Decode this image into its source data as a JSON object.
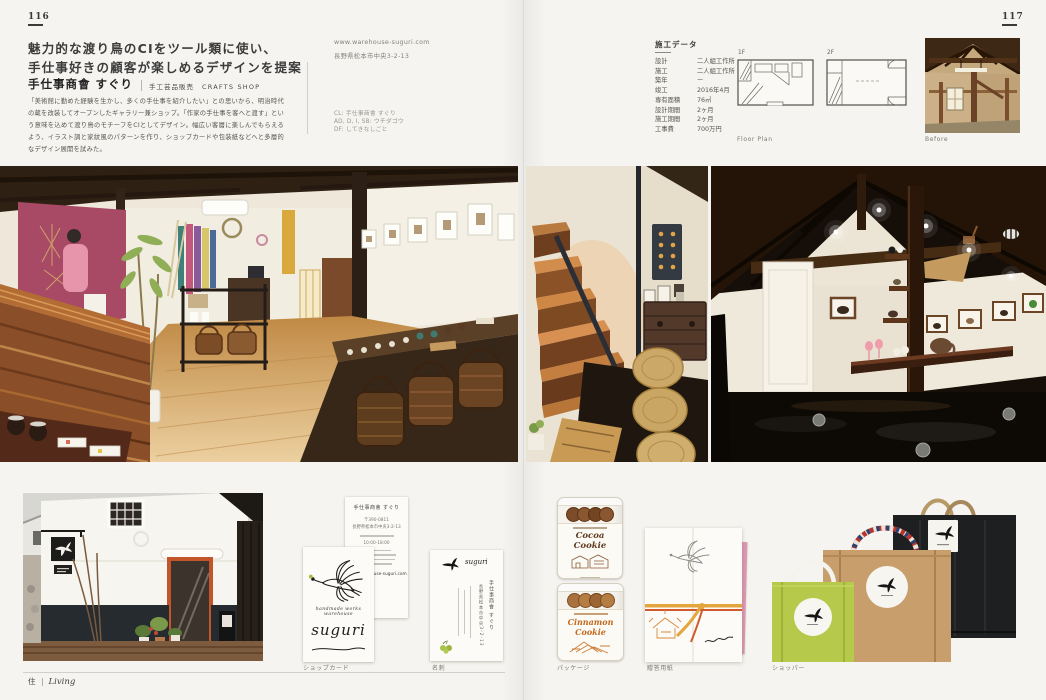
{
  "page": {
    "left_number": "116",
    "right_number": "117"
  },
  "header": {
    "headline1": "魅力的な渡り鳥のCIをツール類に使い、",
    "headline2": "手仕事好きの顧客が楽しめるデザインを提案",
    "shop_name": "手仕事商會 すぐり",
    "category_jp": "手工芸品販売",
    "category_en": "CRAFTS SHOP",
    "body": "「美術館に勤めた経験を生かし、多くの手仕事を紹介したい」との思いから、明治時代の蔵を改装してオープンしたギャラリー兼ショップ。「作家の手仕事を客へと渡す」という意味を込めて渡り鳥のモチーフをCIとしてデザイン。幅広い客層に楽しんでもらえるよう、イラスト調と家紋風のパターンを作り、ショップカードや包装紙などへと多層的なデザイン展開を試みた。",
    "website": "www.warehouse-suguri.com",
    "address": "長野県松本市中央3-2-13",
    "credits": [
      "CL: 手仕事商會 すぐり",
      "AD, D, I, SB: ウチダゴウ",
      "DF: してきなしごと"
    ]
  },
  "construction_data": {
    "title": "施工データ",
    "rows": [
      {
        "label": "設計",
        "value": "二人組工作所"
      },
      {
        "label": "施工",
        "value": "二人組工作所"
      },
      {
        "label": "築年",
        "value": "ー"
      },
      {
        "label": "竣工",
        "value": "2016年4月"
      },
      {
        "label": "専有面積",
        "value": "76㎡"
      },
      {
        "label": "設計期間",
        "value": "2ヶ月"
      },
      {
        "label": "施工期間",
        "value": "2ヶ月"
      },
      {
        "label": "工事費",
        "value": "700万円"
      }
    ],
    "plan_labels": [
      "1F",
      "2F"
    ],
    "plan_caption": "Floor Plan",
    "before_caption": "Before"
  },
  "captions": {
    "shop_card": "ショップカード",
    "business_card": "名刺",
    "package": "パッケージ",
    "gift_paper": "贈答用紙",
    "shopper": "ショッパー"
  },
  "footer": {
    "jp": "住",
    "en": "Living"
  },
  "artifacts": {
    "shop_card": {
      "tagline": "handmade works warehouse",
      "logo": "suguri"
    },
    "back_card": {
      "title": "手仕事商會 すぐり",
      "lines": [
        "〒390-0811",
        "長野県松本市中央3-2-13",
        "10:00-18:00",
        "www.warehouse-suguri.com"
      ]
    },
    "business_card": {
      "logo": "suguri",
      "col1": "手仕事商會 すぐり",
      "col2": "長野県松本市中央3-2-13"
    },
    "jars": {
      "cocoa": "Cocoa Cookie",
      "cinnamon": "Cinnamon Cookie"
    },
    "wrap": {
      "signature": "suguri"
    }
  },
  "colors": {
    "paper": "#f5f4f0",
    "accent_pink_wall": "#a84a66",
    "lime_bag": "#b6c94a",
    "kraft_bag": "#c79e6c",
    "black_bag": "#1d1f20",
    "bird_green": "#a5bf3f"
  }
}
